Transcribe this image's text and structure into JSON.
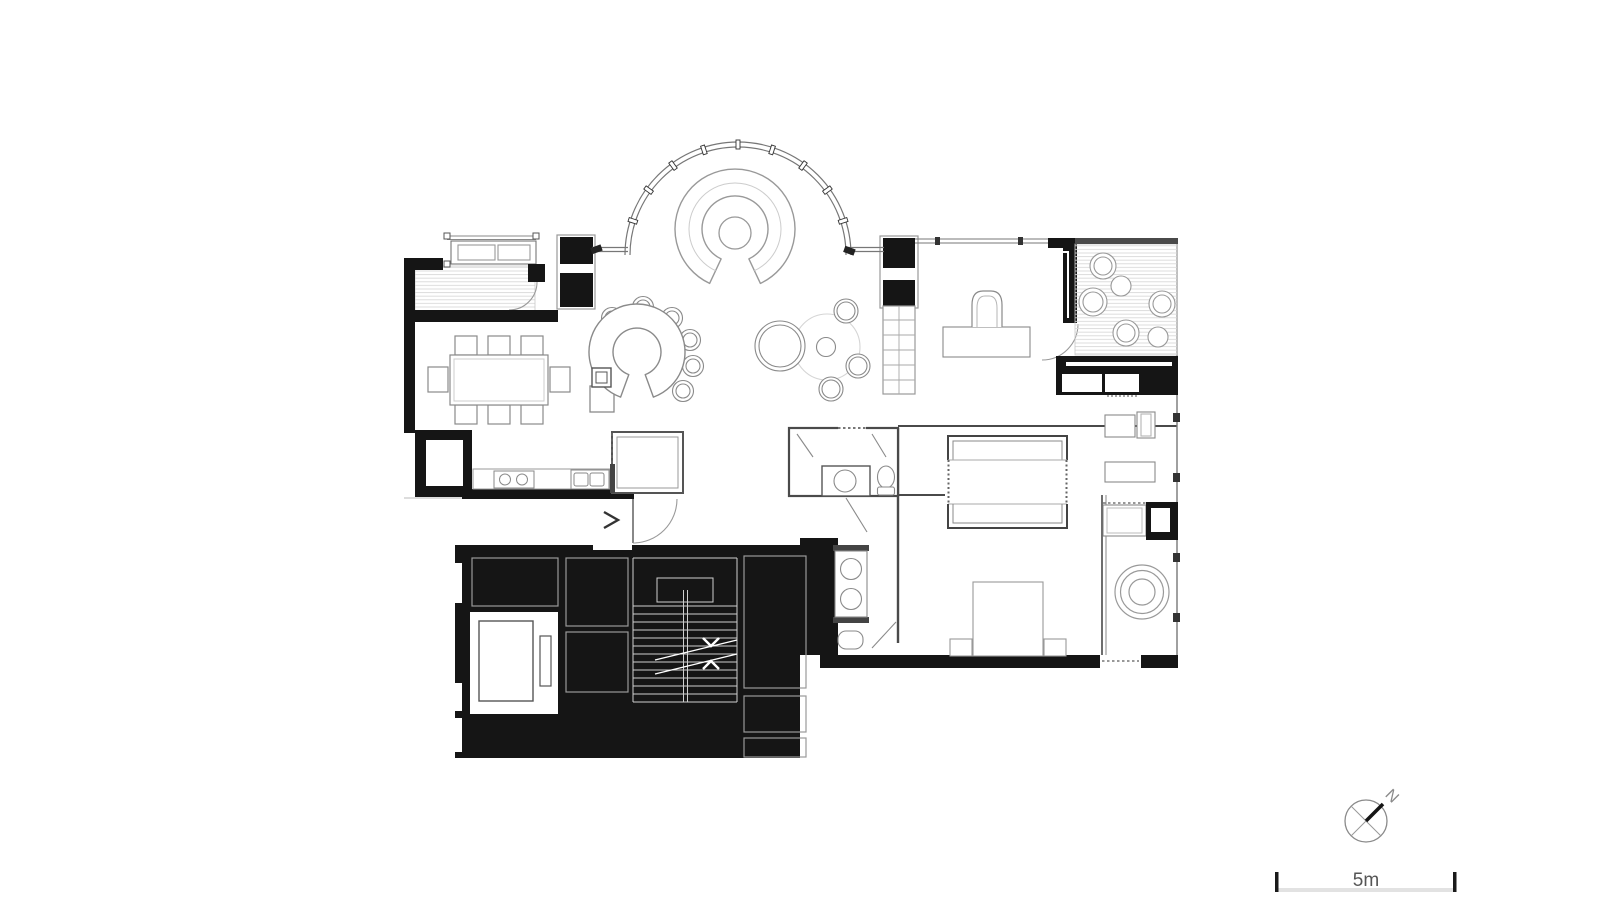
{
  "scale_bar": {
    "label": "5m"
  },
  "compass": {
    "north_label": "N"
  },
  "palette": {
    "background": "#ffffff",
    "poche": "#151515",
    "wall_line": "#4a4a4a",
    "thin_wall_line": "#777777",
    "furniture_line": "#8a8a8a",
    "deck_hatch": "#d9d9d9",
    "stair_tread_line": "#cfcfcf",
    "label_text": "#555555"
  }
}
